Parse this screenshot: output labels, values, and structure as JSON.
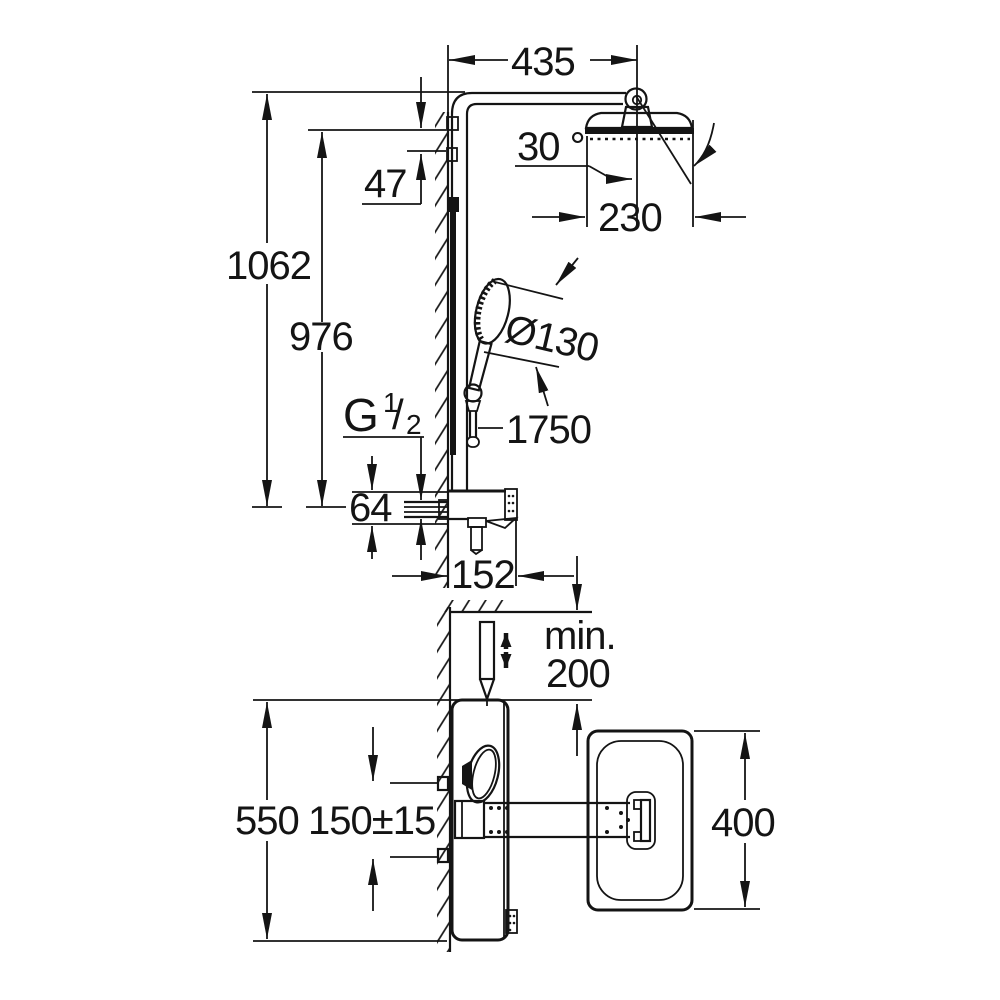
{
  "drawing": {
    "title": "shower-system-installation-dimension-drawing",
    "units": "mm",
    "dimensions": {
      "arm_projection": "435",
      "head_tilt_angle": "30 °",
      "head_diameter": "230",
      "total_height": "1062",
      "upper_bracket_height": "976",
      "bracket_gap": "47",
      "handshower_diameter": "Ø130",
      "hose_length": "1750",
      "thread": {
        "g": "G",
        "numerator": "1",
        "slash": "/",
        "denominator": "2"
      },
      "inlet_size": "64",
      "shelf_depth": "152",
      "min_clearance_label": "min.",
      "min_clearance_value": "200",
      "valve_width": "550",
      "inlet_spacing": "150±15",
      "tray_depth": "400"
    }
  }
}
